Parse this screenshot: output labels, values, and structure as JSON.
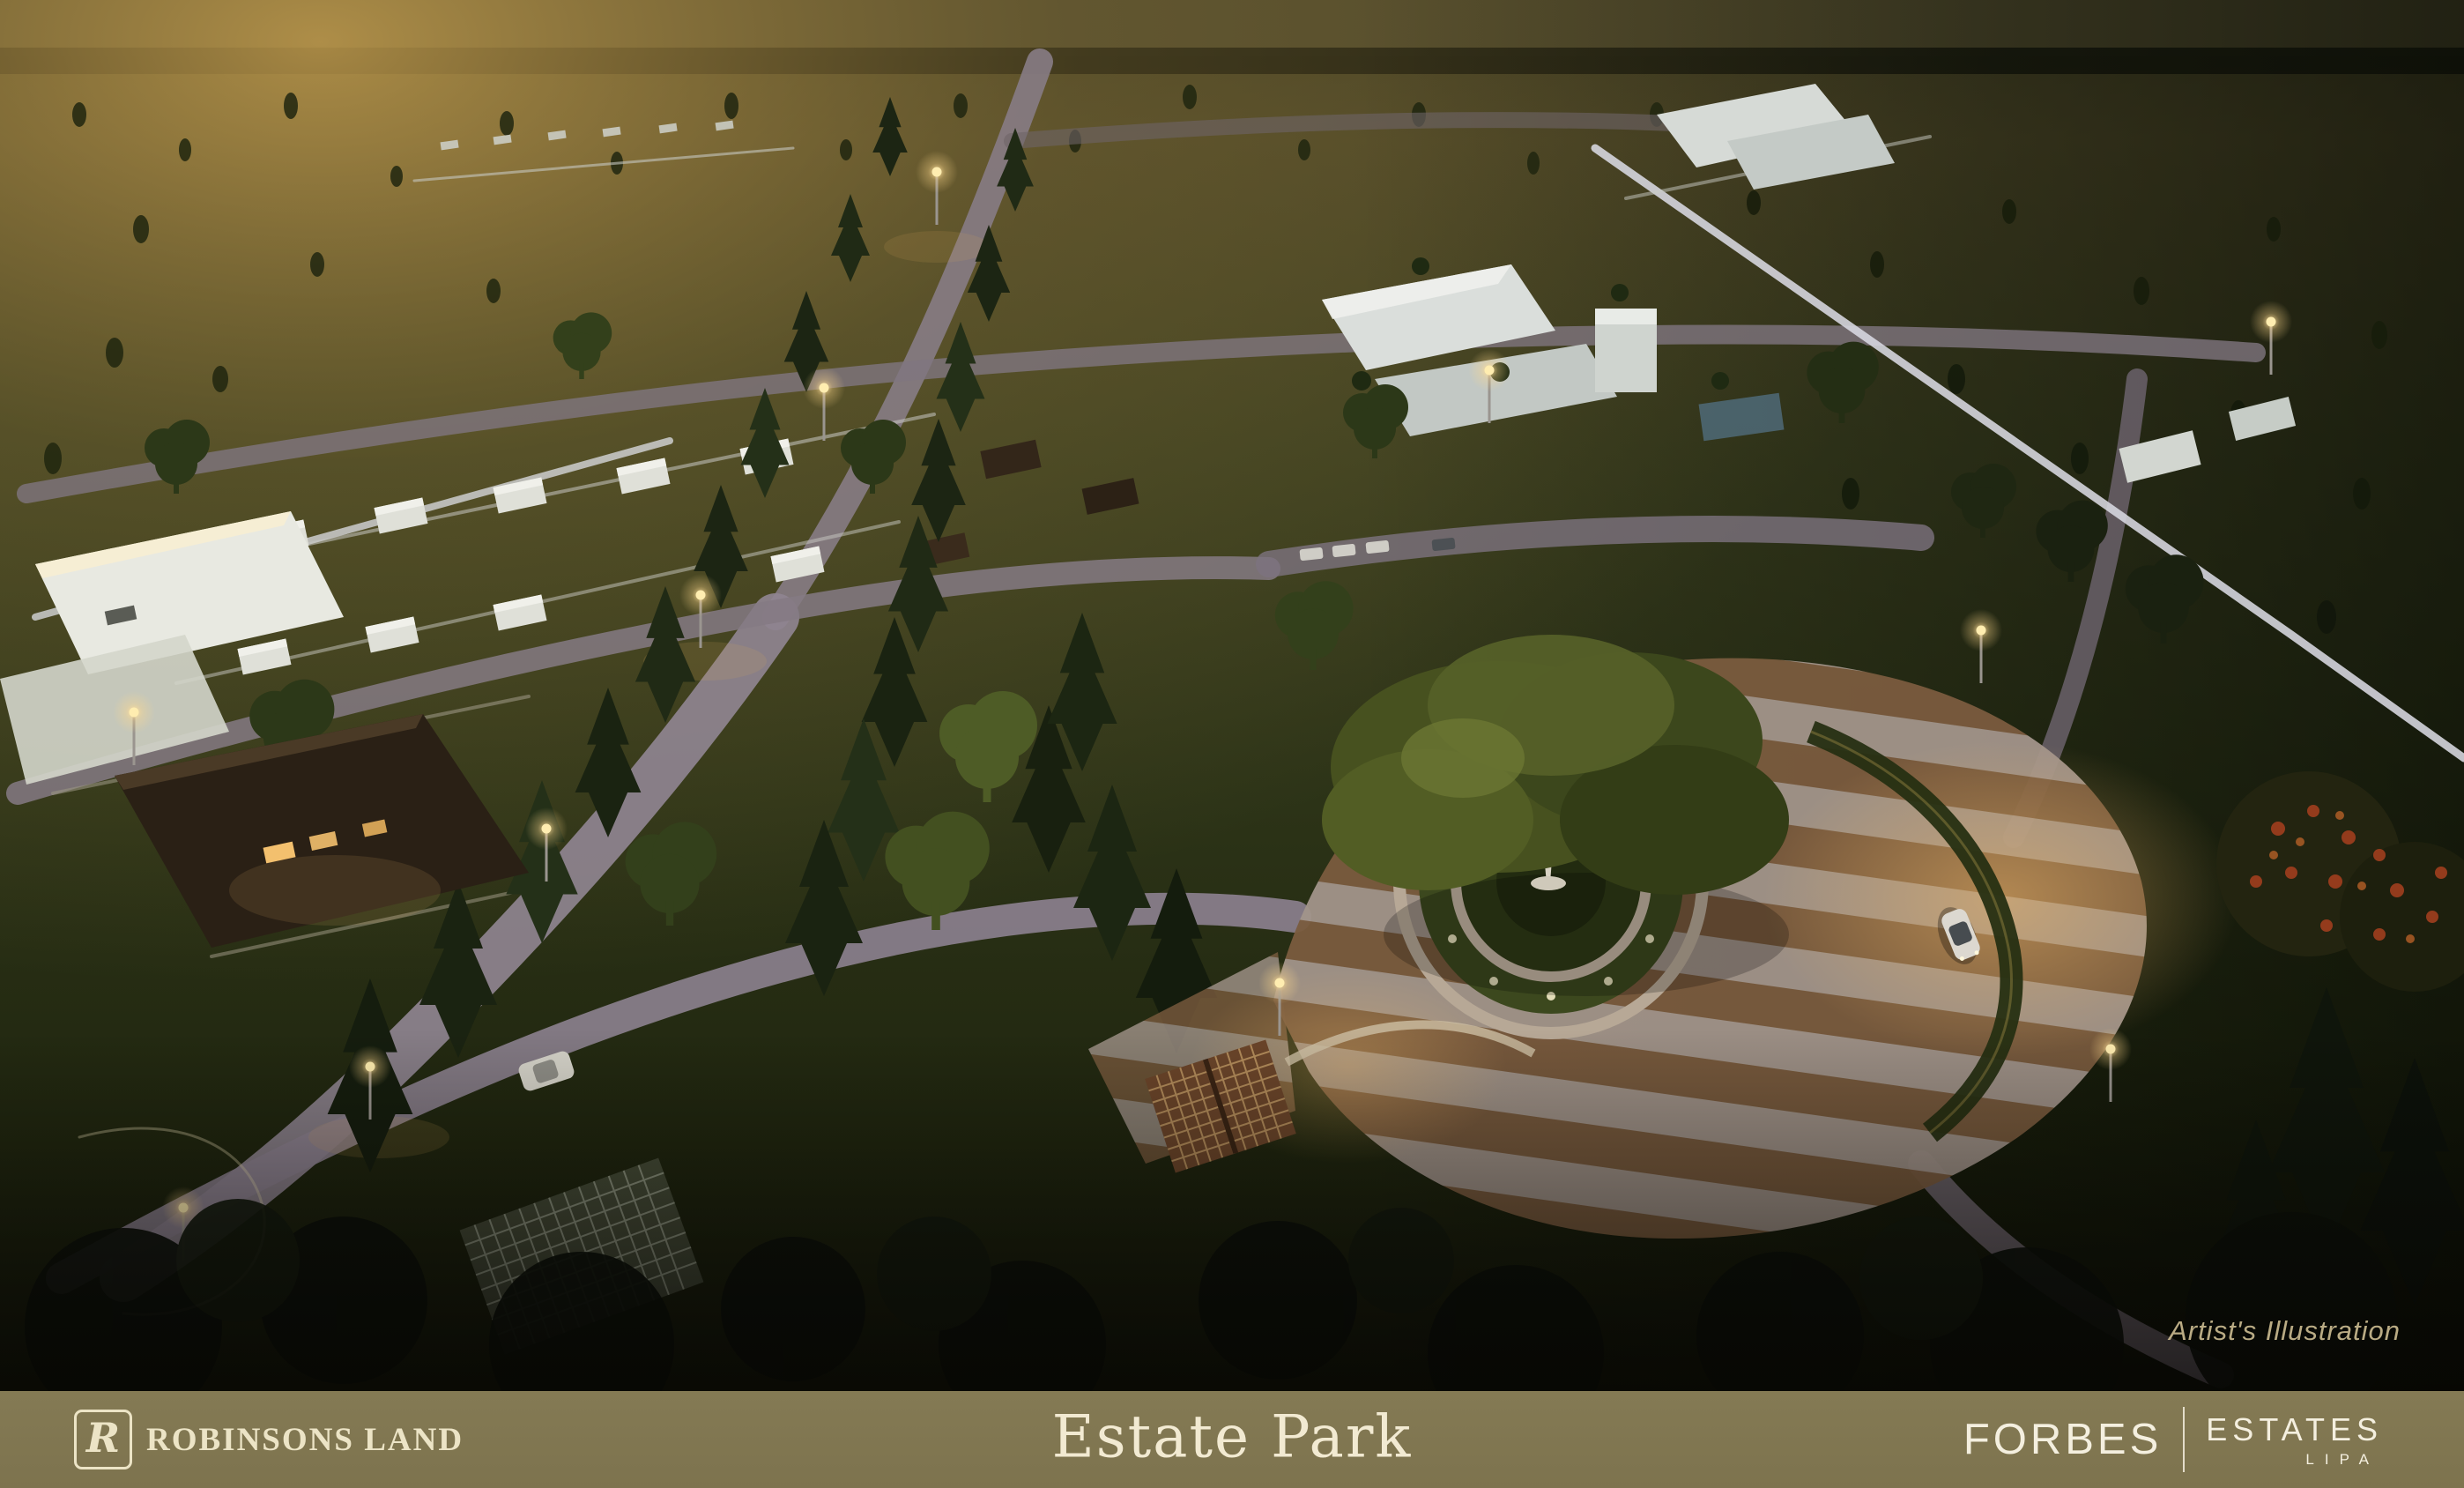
{
  "scene": {
    "caption": "Artist's Illustration",
    "colors": {
      "sunset_gold": "#a8853f",
      "field_olive": "#4a4a24",
      "field_dark": "#1d2410",
      "road": "#8f8490",
      "plaza_tan": "#7a5b3e",
      "plaza_light": "#a2948a",
      "perimeter_wall": "#d9dae2",
      "lamp_warm": "#ffe1a0"
    }
  },
  "footer": {
    "background": "#7e744f",
    "text_color": "#f2ead2",
    "developer": {
      "logo_letter": "R",
      "name": "ROBINSONS LAND"
    },
    "project_title": "Estate Park",
    "brand": {
      "primary": "FORBES",
      "secondary": "ESTATES",
      "location": "LIPA"
    }
  }
}
